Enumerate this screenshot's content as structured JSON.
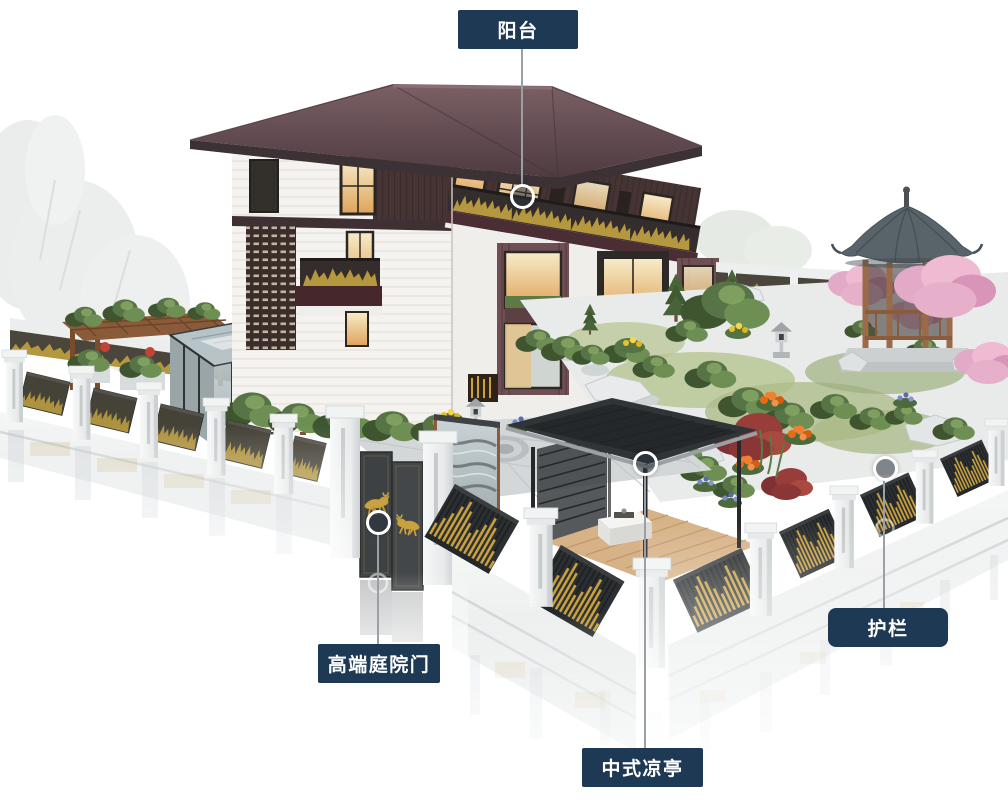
{
  "callouts": {
    "balcony": {
      "label": "阳台"
    },
    "gate": {
      "label": "高端庭院门"
    },
    "pavilion": {
      "label": "中式凉亭"
    },
    "guardrail": {
      "label": "护栏"
    }
  },
  "colors": {
    "background": "#ffffff",
    "callout_box": "#1d3954",
    "callout_text": "#ffffff",
    "leader_line": "#99a1a6",
    "marker_ring": "#ffffff",
    "marker_fill": "rgba(40,50,60,0.55)",
    "roof_maroon": "#5f484d",
    "wood_dark": "#463434",
    "accent_gold": "#c79f3e",
    "fence_panel_dark": "#2c2f31",
    "fence_panel_olive": "#454238",
    "pillar_white": "#eef0f1",
    "gazebo_roof": "#59636a",
    "pergola_wood": "#8a5b3b",
    "deck_wood": "#d7b287"
  },
  "scene": {
    "parts": [
      "villa",
      "balcony-railing",
      "chinese-gazebo",
      "modern-pavilion",
      "courtyard-gate",
      "perimeter-fence",
      "garden",
      "sunroom",
      "pergola"
    ]
  }
}
